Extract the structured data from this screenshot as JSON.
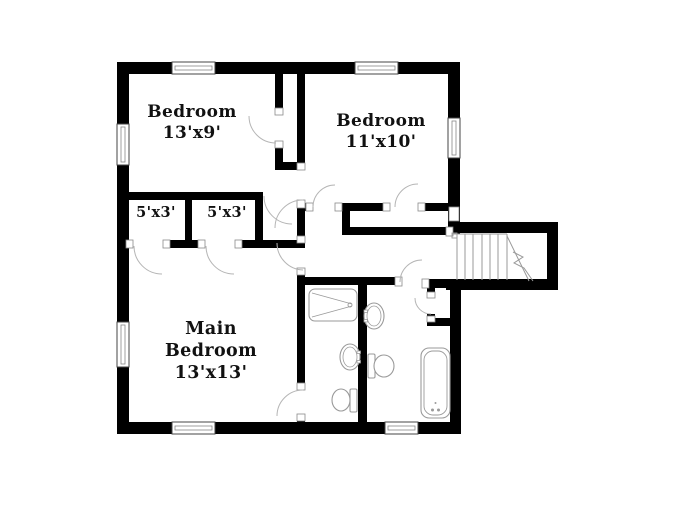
{
  "title": "Upper floor plan",
  "colors": {
    "background": "#ffffff",
    "wall": "#000000",
    "fixture_line": "#9a9a9a",
    "door_line": "#b5b5b5",
    "jamb_line": "#8a8a8a",
    "window_line": "#444444",
    "window_inner": "#888888",
    "text": "#111111"
  },
  "rooms": {
    "bedroom1": {
      "lines": {
        "0": "Bedroom",
        "1": "13'x9'"
      }
    },
    "bedroom2": {
      "lines": {
        "0": "Bedroom",
        "1": "11'x10'"
      }
    },
    "closet_left": {
      "lines": {
        "0": "5'x3'"
      }
    },
    "closet_right": {
      "lines": {
        "0": "5'x3'"
      }
    },
    "main_bedroom": {
      "lines": {
        "0": "Main",
        "1": "Bedroom",
        "2": "13'x13'"
      }
    }
  },
  "plan": {
    "walls": [
      [
        "exterior-top",
        117,
        62,
        341,
        12
      ],
      [
        "exterior-left",
        117,
        62,
        12,
        372
      ],
      [
        "exterior-bottom",
        117,
        422,
        344,
        12
      ],
      [
        "exterior-right-upper",
        448,
        62,
        12,
        172
      ],
      [
        "stair-top",
        448,
        222,
        110,
        11
      ],
      [
        "stair-right",
        547,
        222,
        11,
        68
      ],
      [
        "stair-bottom",
        446,
        279,
        112,
        11
      ],
      [
        "exterior-right-lower",
        450,
        279,
        11,
        155
      ],
      [
        "bedroom1-closet-left-upper",
        275,
        74,
        8,
        41
      ],
      [
        "bedroom1-closet-left-lower",
        275,
        141,
        8,
        29
      ],
      [
        "bedroom1-closet-bottom",
        275,
        162,
        30,
        8
      ],
      [
        "bedroom2-left",
        297,
        74,
        8,
        96
      ],
      [
        "bedroom1-bottom",
        117,
        192,
        146,
        8
      ],
      [
        "closets-divider",
        185,
        196,
        7,
        52
      ],
      [
        "closets-right",
        255,
        192,
        8,
        56
      ],
      [
        "mainbedroom-top-1",
        117,
        240,
        16,
        8
      ],
      [
        "mainbedroom-top-2",
        163,
        240,
        42,
        8
      ],
      [
        "mainbedroom-top-3",
        235,
        240,
        70,
        8
      ],
      [
        "hall-left-1",
        297,
        208,
        8,
        35
      ],
      [
        "hall-left-2",
        297,
        268,
        8,
        20
      ],
      [
        "bedroom2-bottom-1",
        297,
        203,
        16,
        8
      ],
      [
        "bedroom2-bottom-2",
        335,
        203,
        55,
        8
      ],
      [
        "bedroom2-bottom-3",
        418,
        203,
        34,
        8
      ],
      [
        "hallcloset-left",
        342,
        208,
        8,
        27
      ],
      [
        "hallcloset-bottom",
        342,
        227,
        104,
        8
      ],
      [
        "mainbath-left",
        297,
        285,
        8,
        105
      ],
      [
        "mainbath-left-stub",
        297,
        414,
        8,
        8
      ],
      [
        "baths-top",
        303,
        277,
        97,
        8
      ],
      [
        "baths-top-right",
        422,
        279,
        26,
        9
      ],
      [
        "baths-divider",
        358,
        281,
        9,
        141
      ],
      [
        "hallbath-closet-top",
        427,
        288,
        8,
        10
      ],
      [
        "hallbath-closet-left",
        427,
        314,
        8,
        12
      ],
      [
        "hallbath-closet-bottom",
        427,
        318,
        25,
        8
      ]
    ],
    "windows": [
      [
        "window-bedroom1-top",
        172,
        62,
        43,
        12,
        "h"
      ],
      [
        "window-bedroom2-top",
        355,
        62,
        43,
        12,
        "h"
      ],
      [
        "window-bedroom1-left",
        117,
        124,
        12,
        41,
        "v"
      ],
      [
        "window-mainbedroom-left",
        117,
        322,
        12,
        45,
        "v"
      ],
      [
        "window-mainbedroom-bottom",
        172,
        422,
        43,
        12,
        "h"
      ],
      [
        "window-hallbath-bottom",
        385,
        422,
        33,
        12,
        "h"
      ],
      [
        "window-bedroom2-right",
        448,
        118,
        12,
        40,
        "v"
      ]
    ],
    "caps": [
      [
        "cap-hall-stairs",
        446,
        227,
        7,
        9
      ],
      [
        "cap-bedroom2-right-wall",
        449,
        207,
        10,
        14
      ]
    ],
    "doors": [
      {
        "id": "bedroom1-closet-door",
        "jambs": [
          [
            275,
            108,
            8,
            7
          ],
          [
            275,
            141,
            8,
            7
          ]
        ],
        "arc": "M249,116 A27,27 0 0 0 276,143"
      },
      {
        "id": "bedroom1-hall-door",
        "jambs": [
          [
            297,
            163,
            8,
            7
          ],
          [
            297,
            200,
            8,
            8
          ]
        ],
        "arc": "M275,228 A28,28 0 0 1 303,200"
      },
      {
        "id": "bedroom1-entry-arc",
        "jambs": [],
        "arc": "M264,196 A28,28 0 0 0 292,224"
      },
      {
        "id": "mainbedroom-hall-door",
        "jambs": [
          [
            297,
            236,
            8,
            7
          ],
          [
            297,
            268,
            8,
            7
          ]
        ],
        "arc": "M277,243 A27,27 0 0 0 303,270"
      },
      {
        "id": "closet-left-door",
        "jambs": [
          [
            126,
            240,
            7,
            8
          ],
          [
            163,
            240,
            7,
            8
          ]
        ],
        "arc": "M134,246 A28,28 0 0 0 162,274"
      },
      {
        "id": "closet-right-door",
        "jambs": [
          [
            198,
            240,
            7,
            8
          ],
          [
            235,
            240,
            7,
            8
          ]
        ],
        "arc": "M206,246 A28,28 0 0 0 234,274"
      },
      {
        "id": "bedroom2-entry-door",
        "jambs": [
          [
            306,
            203,
            7,
            8
          ],
          [
            335,
            203,
            7,
            8
          ]
        ],
        "arc": "M313,207 A22,22 0 0 1 335,185"
      },
      {
        "id": "bedroom2-closet-door",
        "jambs": [
          [
            383,
            203,
            7,
            8
          ],
          [
            418,
            203,
            7,
            8
          ]
        ],
        "arc": "M395,207 A23,23 0 0 1 418,184"
      },
      {
        "id": "hallbath-entry-door",
        "jambs": [
          [
            395,
            277,
            7,
            9
          ],
          [
            422,
            279,
            7,
            9
          ]
        ],
        "arc": "M400,282 A22,22 0 0 1 422,260"
      },
      {
        "id": "hallbath-closet-door",
        "jambs": [
          [
            427,
            292,
            8,
            6
          ],
          [
            427,
            316,
            8,
            6
          ]
        ],
        "arc": "M415,298 A16,16 0 0 0 431,314"
      },
      {
        "id": "mainbath-door",
        "jambs": [
          [
            297,
            383,
            8,
            7
          ],
          [
            297,
            414,
            8,
            7
          ]
        ],
        "arc": "M277,416 A26,26 0 0 1 303,390"
      }
    ],
    "fixtures": [
      {
        "id": "bathtub-main-bath",
        "type": "tub-h",
        "x": 309,
        "y": 289,
        "w": 48,
        "h": 32
      },
      {
        "id": "sink-main-bath",
        "type": "sink",
        "cx": 350,
        "cy": 357,
        "tick_side": "right"
      },
      {
        "id": "toilet-main-bath",
        "type": "toilet",
        "tank": [
          350,
          389,
          7,
          23
        ],
        "bowl": [
          341,
          400,
          9,
          11
        ]
      },
      {
        "id": "sink-hall-bath",
        "type": "sink",
        "cx": 374,
        "cy": 316,
        "tick_side": "left"
      },
      {
        "id": "toilet-hall-bath",
        "type": "toilet",
        "tank": [
          368,
          354,
          7,
          24
        ],
        "bowl": [
          384,
          366,
          10,
          11
        ]
      },
      {
        "id": "bathtub-hall-bath",
        "type": "tub-v",
        "x": 421,
        "y": 348,
        "w": 29,
        "h": 70
      }
    ],
    "stairs": {
      "id": "stairs",
      "treads_x": [
        457,
        465,
        473,
        482,
        490,
        498,
        507
      ],
      "tread_y1": 234,
      "tread_y2": 280,
      "top_line": [
        452,
        234,
        507,
        234
      ],
      "post": [
        452,
        233,
        5,
        5
      ],
      "diag": [
        507,
        236,
        529,
        281
      ],
      "zigzag": "513,252 523,257 514,263 524,268 533,281"
    }
  }
}
